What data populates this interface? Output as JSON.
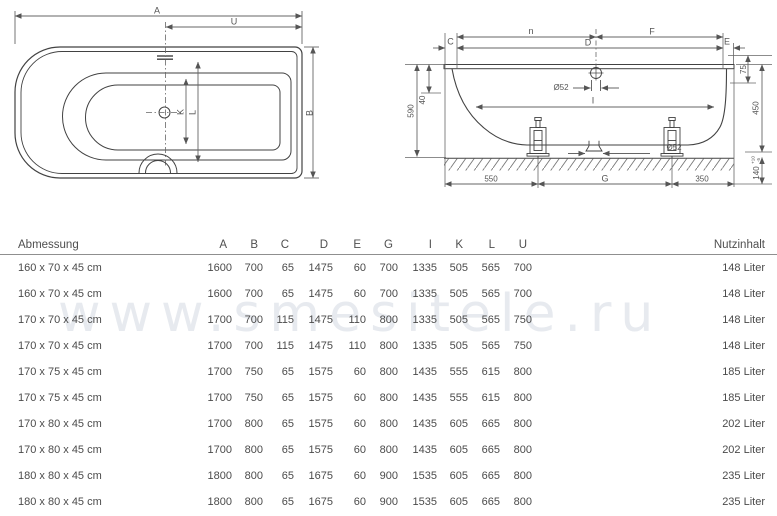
{
  "watermark": "www.smesitele.ru",
  "top_view": {
    "label_a": "A",
    "label_u": "U",
    "label_b": "B",
    "label_k": "K",
    "label_l": "L"
  },
  "side_view": {
    "label_n": "n",
    "label_f": "F",
    "label_c": "C",
    "label_d": "D",
    "label_e": "E",
    "label_i": "I",
    "dia_overflow": "Ø52",
    "dia_drain": "Ø52",
    "dim_590": "590",
    "dim_40": "40",
    "dim_550": "550",
    "dim_g": "G",
    "dim_350": "350",
    "dim_75": "75",
    "dim_450": "450",
    "dim_140": "140",
    "tol_plus": "+10",
    "tol_minus": "-5"
  },
  "table": {
    "header": {
      "dimension": "Abmessung",
      "letters": [
        "A",
        "B",
        "C",
        "D",
        "E",
        "G",
        "I",
        "K",
        "L",
        "U"
      ],
      "volume": "Nutzinhalt"
    },
    "rows": [
      {
        "size": "160 x 70 x 45 cm",
        "values": [
          "1600",
          "700",
          "65",
          "1475",
          "60",
          "700",
          "1335",
          "505",
          "565",
          "700"
        ],
        "volume": "148 Liter"
      },
      {
        "size": "160 x 70 x 45 cm",
        "values": [
          "1600",
          "700",
          "65",
          "1475",
          "60",
          "700",
          "1335",
          "505",
          "565",
          "700"
        ],
        "volume": "148 Liter"
      },
      {
        "size": "170 x 70 x 45 cm",
        "values": [
          "1700",
          "700",
          "115",
          "1475",
          "110",
          "800",
          "1335",
          "505",
          "565",
          "750"
        ],
        "volume": "148 Liter"
      },
      {
        "size": "170 x 70 x 45 cm",
        "values": [
          "1700",
          "700",
          "115",
          "1475",
          "110",
          "800",
          "1335",
          "505",
          "565",
          "750"
        ],
        "volume": "148 Liter"
      },
      {
        "size": "170 x 75 x 45 cm",
        "values": [
          "1700",
          "750",
          "65",
          "1575",
          "60",
          "800",
          "1435",
          "555",
          "615",
          "800"
        ],
        "volume": "185 Liter"
      },
      {
        "size": "170 x 75 x 45 cm",
        "values": [
          "1700",
          "750",
          "65",
          "1575",
          "60",
          "800",
          "1435",
          "555",
          "615",
          "800"
        ],
        "volume": "185 Liter"
      },
      {
        "size": "170 x 80 x 45 cm",
        "values": [
          "1700",
          "800",
          "65",
          "1575",
          "60",
          "800",
          "1435",
          "605",
          "665",
          "800"
        ],
        "volume": "202 Liter"
      },
      {
        "size": "170 x 80 x 45 cm",
        "values": [
          "1700",
          "800",
          "65",
          "1575",
          "60",
          "800",
          "1435",
          "605",
          "665",
          "800"
        ],
        "volume": "202 Liter"
      },
      {
        "size": "180 x 80 x 45 cm",
        "values": [
          "1800",
          "800",
          "65",
          "1675",
          "60",
          "900",
          "1535",
          "605",
          "665",
          "800"
        ],
        "volume": "235 Liter"
      },
      {
        "size": "180 x 80 x 45 cm",
        "values": [
          "1800",
          "800",
          "65",
          "1675",
          "60",
          "900",
          "1535",
          "605",
          "665",
          "800"
        ],
        "volume": "235 Liter"
      }
    ]
  }
}
